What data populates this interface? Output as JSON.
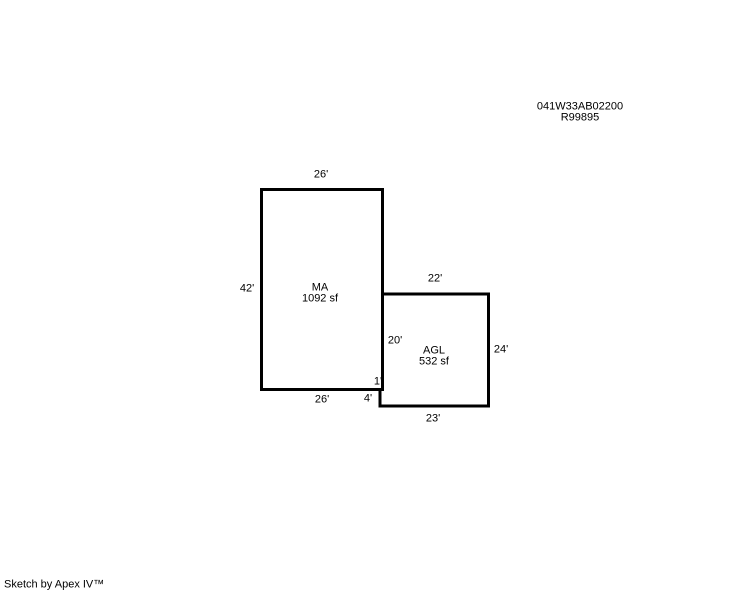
{
  "page": {
    "background_color": "#ffffff",
    "line_color": "#000000",
    "text_color": "#000000"
  },
  "header": {
    "parcel_id": "041W33AB02200",
    "record_number": "R99895"
  },
  "sketch": {
    "areas": [
      {
        "code": "MA",
        "area": "1092 sf",
        "dims": {
          "top": "26'",
          "left": "42'",
          "bottom": "26'"
        }
      },
      {
        "code": "AGL",
        "area": "532 sf",
        "dims": {
          "top": "22'",
          "left": "20'",
          "right": "24'",
          "bottom": "23'",
          "notch_width": "1'",
          "notch_height": "4'"
        }
      }
    ]
  },
  "footer": {
    "credit": "Sketch by Apex IV™"
  }
}
